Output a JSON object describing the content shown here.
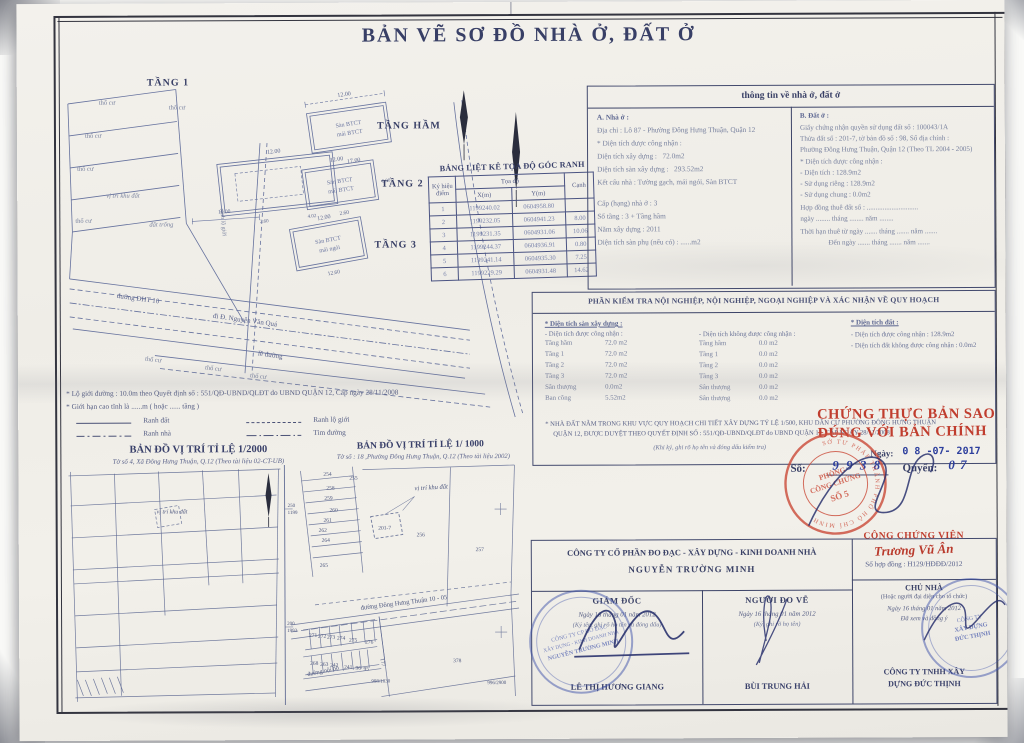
{
  "title": "BẢN VẼ SƠ ĐỒ NHÀ Ở, ĐẤT Ở",
  "plans": {
    "floor1": "TẦNG 1",
    "basement": "TẦNG HẦM",
    "floor2": "TẦNG 2",
    "floor3": "TẦNG 3",
    "tho_cu": "thổ cư",
    "vi_tri_khu_dat": "vị trí khu đất",
    "dat_trong": "đất trống",
    "duong_dht10": "đường ĐHT 10",
    "di_nvq": "đi Đ. Nguyễn Văn Quá",
    "le_duong": "lề đường",
    "ranh_lo_gioi": "ranh lộ giới",
    "san": "Sàn BTCT",
    "mai_btct": "mái BTCT",
    "mai_ngoi": "mái ngói",
    "dim_12": "12.00",
    "dim_17": "17.00",
    "dim_2_60": "2.60",
    "dim_6": "6.00",
    "dim_12_60": "12.60",
    "dim_10": "10.00",
    "dim_4_02": "4.02"
  },
  "coord_table": {
    "title": "BẢNG LIỆT KÊ TỌA ĐỘ GÓC RANH",
    "col_point_1": "Ký hiệu",
    "col_point_2": "điểm",
    "col_coords": "Tọa độ",
    "col_x": "X(m)",
    "col_y": "Y(m)",
    "col_edge": "Cạnh",
    "rows": [
      {
        "p": "1",
        "x": "1199240.02",
        "y": "0604958.80",
        "c": ""
      },
      {
        "p": "2",
        "x": "1199232.05",
        "y": "0604941.23",
        "c": "8.00"
      },
      {
        "p": "3",
        "x": "1199231.35",
        "y": "0604931.06",
        "c": "10.06"
      },
      {
        "p": "4",
        "x": "1199244.37",
        "y": "0604936.91",
        "c": "0.80"
      },
      {
        "p": "5",
        "x": "1199241.14",
        "y": "0604935.30",
        "c": "7.25"
      },
      {
        "p": "6",
        "x": "1199229.29",
        "y": "0604931.48",
        "c": "14.62"
      }
    ]
  },
  "info": {
    "title": "thông tin về nhà ở, đất ở",
    "a": {
      "heading": "A. Nhà ở :",
      "address": "Địa chỉ : Lô 87 - Phường Đông Hưng Thuận, Quận 12",
      "recognized": "* Diện tích được công nhận :",
      "build_label": "Diện tích xây dựng :",
      "build_value": "72.0m2",
      "floor_label": "Diện tích sàn xây dựng :",
      "floor_value": "293.52m2",
      "structure": "Kết cấu nhà : Tường gạch, mái ngói, Sàn BTCT",
      "grade": "Cấp (hạng) nhà ở :  3",
      "floors": "Số tầng :  3 + Tầng hầm",
      "year": "Năm xây dựng :  2011",
      "aux": "Diện tích sàn phụ (nếu có) : ......m2"
    },
    "b": {
      "heading": "B. Đất ở :",
      "cert": "Giấy chứng nhận quyền sử dụng đất số : 100043/1A",
      "parcel": "Thửa đất số : 201-7, tờ bản đồ số : 98, Sổ địa chính :",
      "ward": "Phường Đông Hưng Thuận, Quận 12 (Theo TL 2004 - 2005)",
      "recognized": "* Diện tích được công nhận :",
      "area": "- Diện tích :  128.9m2",
      "priv": "- Sử dụng riêng :  128.9m2",
      "shared": "- Sử dụng chung :  0.0m2",
      "lease": "Hợp đồng thuê đất số : .............................",
      "lease_date": "ngày ........ tháng ........ năm ........",
      "term": "Thời hạn thuê từ ngày ....... tháng ....... năm .......",
      "term_end": "Đến ngày ....... tháng ....... năm ......."
    }
  },
  "inspection": {
    "title": "PHẦN KIỂM TRA NỘI NGHIỆP, NỘI NGHIỆP, NGOẠI NGHIỆP VÀ XÁC NHẬN VỀ QUY HOẠCH",
    "floor_heading": "* Diện tích sàn xây dựng :",
    "recognized_heading": "- Diện tích được công nhận :",
    "not_recognized_heading": "- Diện tích không được công nhận :",
    "recognized_rows": [
      [
        "Tầng hầm",
        "72.0 m2"
      ],
      [
        "Tầng 1",
        "72.0 m2"
      ],
      [
        "Tầng 2",
        "72.0 m2"
      ],
      [
        "Tầng 3",
        "72.0 m2"
      ],
      [
        "Sân thượng",
        "0.0m2"
      ],
      [
        "Ban công",
        "5.52m2"
      ]
    ],
    "not_recognized_rows": [
      [
        "Tầng hầm",
        "0.0 m2"
      ],
      [
        "Tầng 1",
        "0.0 m2"
      ],
      [
        "Tầng 2",
        "0.0 m2"
      ],
      [
        "Tầng 3",
        "0.0 m2"
      ],
      [
        "Sân thượng",
        "0.0 m2"
      ],
      [
        "Sân thượng",
        "0.0 m2"
      ]
    ],
    "land_heading": "* Diện tích đất :",
    "land_recognized": "- Diện tích được công nhận :   128.9m2",
    "land_not_recognized": "- Diện tích đất không được công nhận : 0.0m2",
    "note1": "* NHÀ ĐẤT NẰM TRONG KHU VỰC QUY HOẠCH CHI TIẾT XÂY DỰNG TỶ LỆ 1/500, KHU DÂN CƯ PHƯỜNG ĐÔNG HƯNG THUẬN",
    "note2": "QUẬN 12, ĐƯỢC DUYỆT THEO QUYẾT ĐỊNH SỐ : 551/QĐ-UBND/QLĐT do UBND QUẬN 12, CẤP NGÀY 28/11/2008",
    "sign_note": "(Khi ký, ghi rõ họ tên và đóng dấu kiểm tra)"
  },
  "certification": {
    "line1": "CHỨNG THỰC BẢN SAO",
    "line2": "ĐÚNG VỚI BẢN CHÍNH",
    "date_label": "Ngày:",
    "date_value": "0 8 -07- 2017",
    "no_label": "Số:",
    "no_value": "9 9 3 8",
    "book_label": "Quyển:",
    "book_value": "0 7",
    "seal_ring": "SỞ TƯ PHÁP THÀNH PHỐ HỒ CHÍ MINH",
    "seal_l1": "PHÒNG",
    "seal_l2": "CÔNG CHỨNG",
    "seal_l3": "SỐ 5",
    "notary_title": "CÔNG CHỨNG VIÊN",
    "notary_name": "Trương Vũ Ân",
    "contract": "Số hợp đồng : H129/HĐĐĐ/2012"
  },
  "legend": {
    "road_line": "* Lộ giới đường : 10.0m theo Quyết định số : 551/QĐ-UBND/QLĐT do UBND QUẬN 12, Cấp ngày 28/11/2008",
    "height_line": "* Giới hạn cao tĩnh là ......m ( hoặc ...... tầng )",
    "ranh_dat": "Ranh đất",
    "ranh_lo_gioi": "Ranh lộ giới",
    "ranh_nha": "Ranh nhà",
    "tim_duong": "Tim đường"
  },
  "maps": {
    "m2000_title": "BẢN ĐỒ VỊ TRÍ TỈ LỆ 1/2000",
    "m2000_sub": "Tờ số 4, Xã Đông Hưng Thuận, Q.12 (Theo tài liệu 02-CT-UB)",
    "m1000_title": "BẢN ĐỒ VỊ TRÍ TỈ LỆ 1/ 1000",
    "m1000_sub": "Tờ số : 18 ,Phường Đông Hưng Thuận, Q.12 (Theo tài liệu 2002)",
    "vi_tri_khu_dat": "vị trí khu đất",
    "road_dht": "đường Đông Hưng Thuận 10 - 05",
    "road_noibo": "đường nội bộ",
    "nums": [
      "254",
      "255",
      "258",
      "259",
      "260",
      "261",
      "262",
      "264",
      "265",
      "201-7",
      "256",
      "257",
      "271",
      "272",
      "273",
      "274",
      "275",
      "276",
      "268",
      "263",
      "242",
      "241",
      "96",
      "95",
      "177",
      "378"
    ],
    "ref_250a": "250",
    "ref_250b": "1199",
    "ref_200a": "200",
    "ref_200b": "1993",
    "ref_998": "998/1830",
    "ref_996": "996/2900"
  },
  "company": {
    "name1": "CÔNG TY CỔ PHẦN ĐO ĐẠC - XÂY DỰNG - KINH DOANH NHÀ",
    "name2": "NGUYỄN TRƯỜNG MINH",
    "director_title": "GIÁM ĐỐC",
    "surveyor_title": "NGƯỜI ĐO VẼ",
    "owner_title": "CHỦ NHÀ",
    "owner_sub": "(Hoặc người đại diện cho tổ chức)",
    "director_date": "Ngày 16 tháng 01 năm 2012",
    "director_note": "(Ký tên, ghi rõ họ tên và đóng dấu)",
    "surveyor_date": "Ngày 16 tháng 01 năm 2012",
    "surveyor_note": "(Ký, ghi rõ họ tên)",
    "owner_date": "Ngày 16 tháng 01 năm 2012",
    "owner_note": "Đã xem và đồng ý",
    "director_name": "LÊ THỊ HƯƠNG GIANG",
    "surveyor_name": "BÙI TRUNG HẢI",
    "owner_name1": "CÔNG TY TNHH XÂY",
    "owner_name2": "DỰNG ĐỨC THỊNH"
  },
  "stamps": {
    "left": {
      "l1": "CÔNG TY CP ĐO ĐẠC",
      "l2": "XÂY DỰNG - KINH DOANH NHÀ",
      "l3": "NGUYỄN TRƯỜNG MINH"
    },
    "right": {
      "l1": "CÔNG TY",
      "l2": "XÂY DỰNG",
      "l3": "ĐỨC THỊNH"
    }
  }
}
